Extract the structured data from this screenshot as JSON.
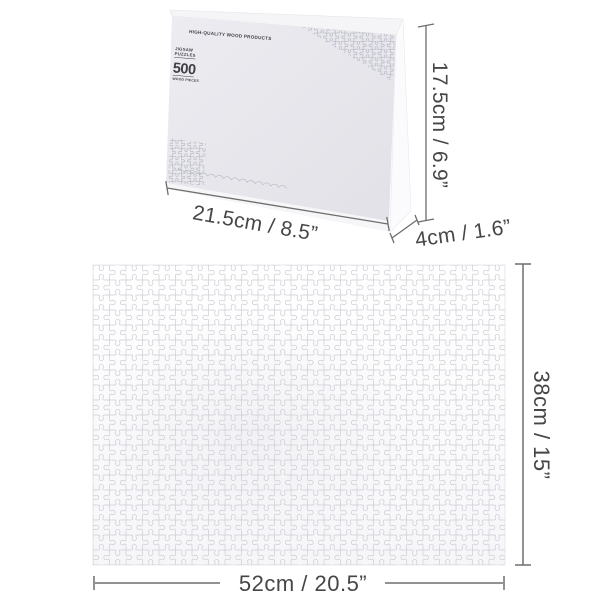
{
  "box": {
    "brand_text": "HIGH-QUALITY WOOD PRODUCTS",
    "label": {
      "line1": "JIGSAW",
      "line2": "PUZZLES",
      "count": "500",
      "subtext": "WOOD PIECES"
    },
    "size_text": "SIZE:520X380mm"
  },
  "dimensions": {
    "box_width": "21.5cm / 8.5”",
    "box_height": "17.5cm / 6.9”",
    "box_depth": "4cm / 1.6”",
    "puzzle_width": "52cm / 20.5”",
    "puzzle_height": "38cm / 15”"
  },
  "colors": {
    "page_bg": "#ffffff",
    "dimension_line": "#6e6e6e",
    "dimension_text": "#464646",
    "box_front": "#e7e7ec",
    "box_top": "#f5f5f8",
    "box_side": "#fbfbfd",
    "box_print": "#3f3f46",
    "puzzle_line": "#ccccd4",
    "box_pattern_line": "#b2b2bf"
  }
}
